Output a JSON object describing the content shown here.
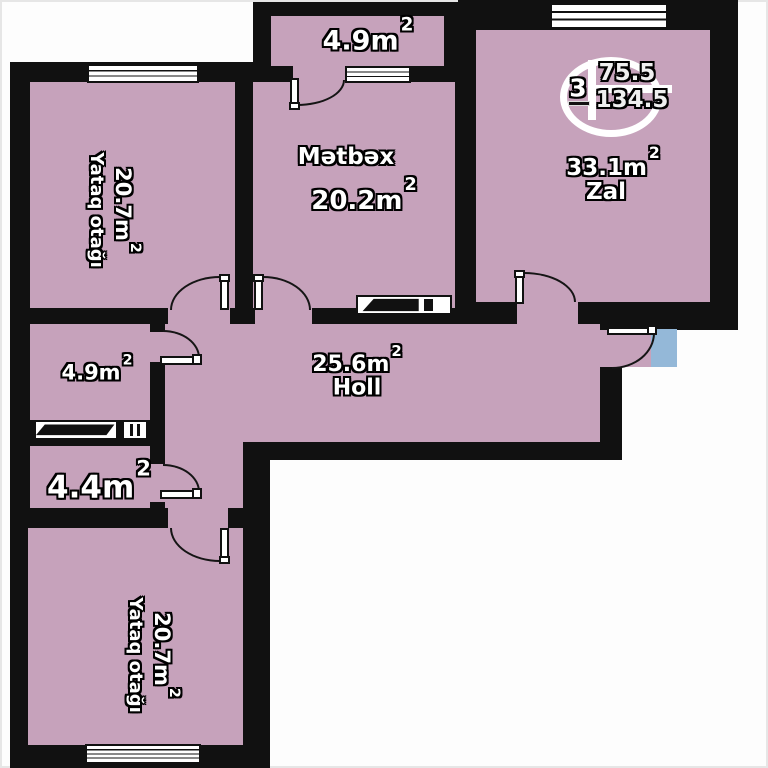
{
  "stamp": {
    "room_count": "3",
    "upper_value": "75.5",
    "lower_value": "134.5"
  },
  "rooms": {
    "balcony": {
      "area": "4.9m",
      "sup": "2"
    },
    "kitchen": {
      "name": "Mətbəx",
      "area": "20.2m",
      "sup": "2"
    },
    "living_room": {
      "name": "Zal",
      "area": "33.1m",
      "sup": "2"
    },
    "bedroom_top": {
      "name": "Yataq otağı",
      "area": "20.7m",
      "sup": "2"
    },
    "hall": {
      "name": "Holl",
      "area": "25.6m",
      "sup": "2"
    },
    "bathroom": {
      "area": "4.9m",
      "sup": "2"
    },
    "storage": {
      "area": "4.4m",
      "sup": "2"
    },
    "bedroom_bottom": {
      "name": "Yataq otağı",
      "area": "20.7m",
      "sup": "2"
    }
  },
  "colors": {
    "floor": "#c6a2bb",
    "wall": "#111111",
    "entry_pad": "#94b8d8",
    "background": "#ffffff"
  }
}
